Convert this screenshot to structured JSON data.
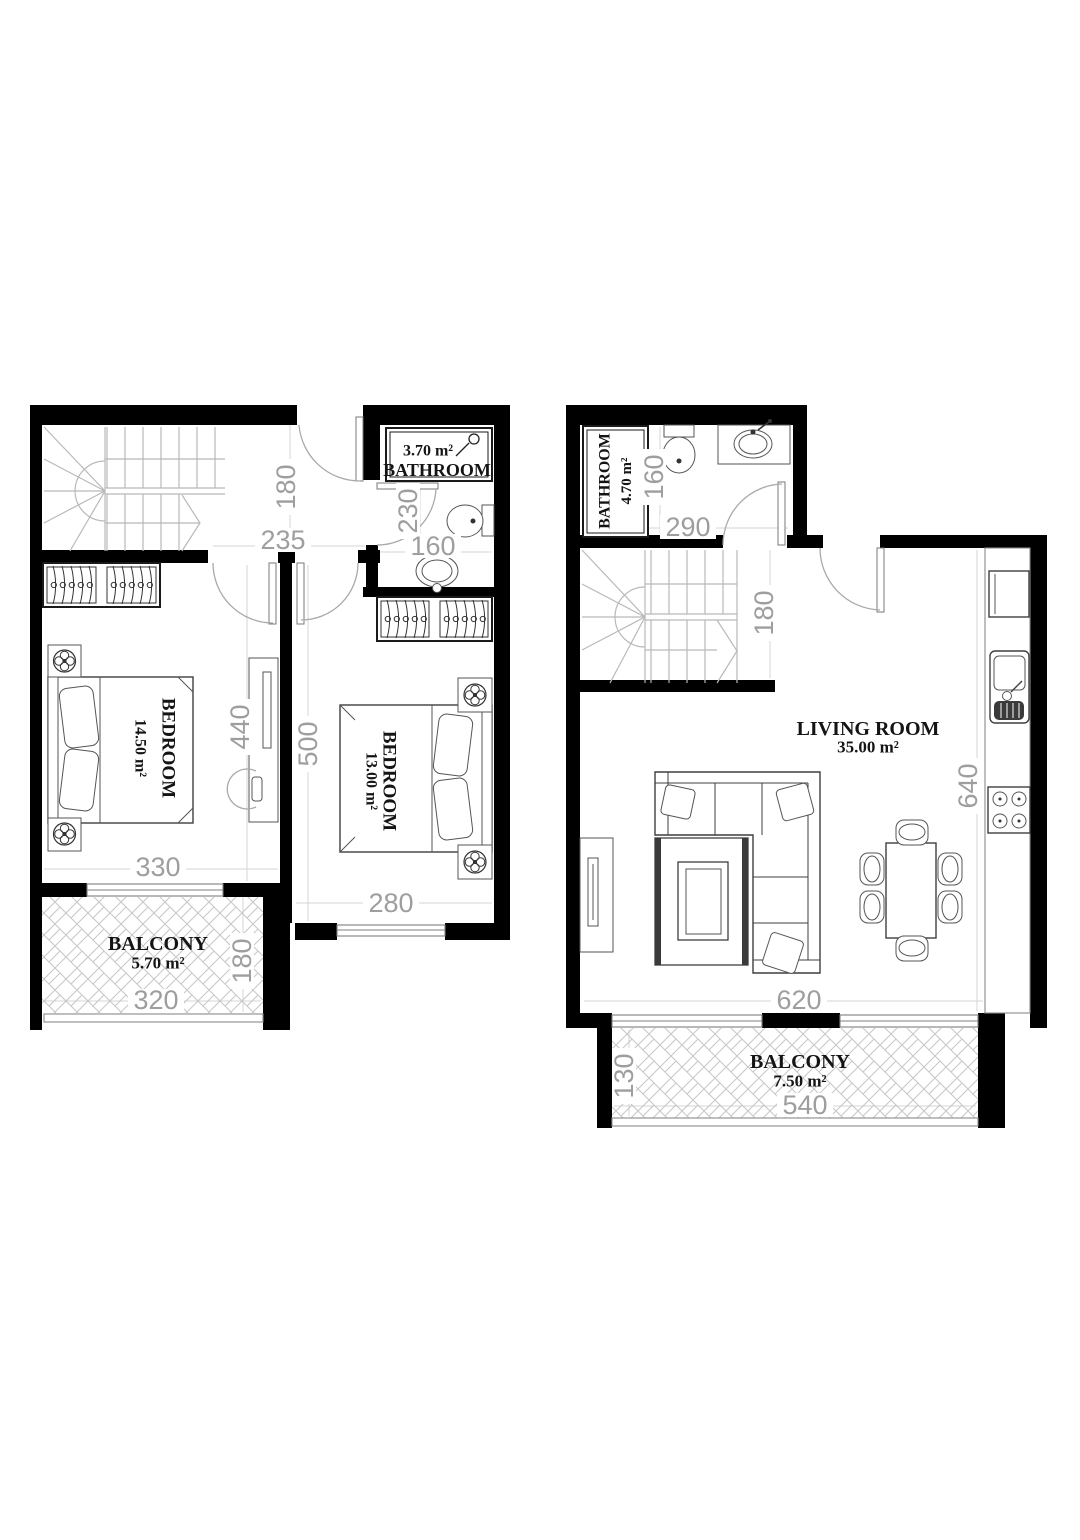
{
  "document": {
    "type": "architectural floor plan, duplex apartment, two levels side by side"
  },
  "colors": {
    "wall": "#000000",
    "dimension_text": "#9e9e9e",
    "label_text": "#141414",
    "guide_line": "#d4d4d4",
    "hatch": "#c6c6c6",
    "furniture_line": "#3f3f3f"
  },
  "floor1": {
    "name": "bedroom-level-plan",
    "bathroom": {
      "area": "3.70 m²",
      "label": "BATHROOM"
    },
    "bedroom1": {
      "label": "BEDROOM",
      "area": "14.50 m²"
    },
    "bedroom2": {
      "label": "BEDROOM",
      "area": "13.00 m²"
    },
    "balcony": {
      "label": "BALCONY",
      "area": "5.70 m²"
    },
    "dims": {
      "hall_width": "180",
      "hall_length": "235",
      "bathroom_depth": "230",
      "bathroom_width": "160",
      "bedroom1_depth": "440",
      "bedroom2_depth": "500",
      "bedroom1_width": "330",
      "bedroom2_width": "280",
      "balcony_width": "320",
      "balcony_depth": "180"
    }
  },
  "floor2": {
    "name": "living-level-plan",
    "bathroom": {
      "label": "BATHROOM",
      "area": "4.70 m²"
    },
    "living_room": {
      "label": "LIVING ROOM",
      "area": "35.00 m²"
    },
    "balcony": {
      "label": "BALCONY",
      "area": "7.50 m²"
    },
    "dims": {
      "bathroom_width": "160",
      "bathroom_length": "290",
      "hall_width": "180",
      "kitchen_run": "640",
      "living_width": "620",
      "balcony_depth": "130",
      "balcony_width": "540"
    }
  },
  "icons": {
    "stairs": "u-turn-staircase",
    "door": "door-swing-arc",
    "window": "sliding-window",
    "wardrobe": "wardrobe-with-hangers",
    "bed": "double-bed-top-view",
    "plant": "flower-pot",
    "dressing_table": "dresser-with-mirror-and-stool",
    "toilet": "toilet-top-view",
    "sink": "oval-basin",
    "shower": "shower-head",
    "vanity": "vanity-counter-basin",
    "sofa": "l-shaped-sofa-with-pillows",
    "coffee_table": "rug-with-coffee-table",
    "tv": "tv-stand",
    "dining": "dining-table-six-chairs",
    "fridge": "refrigerator",
    "kitchen_sink": "sink-with-drainer",
    "stove": "four-burner-hob"
  }
}
